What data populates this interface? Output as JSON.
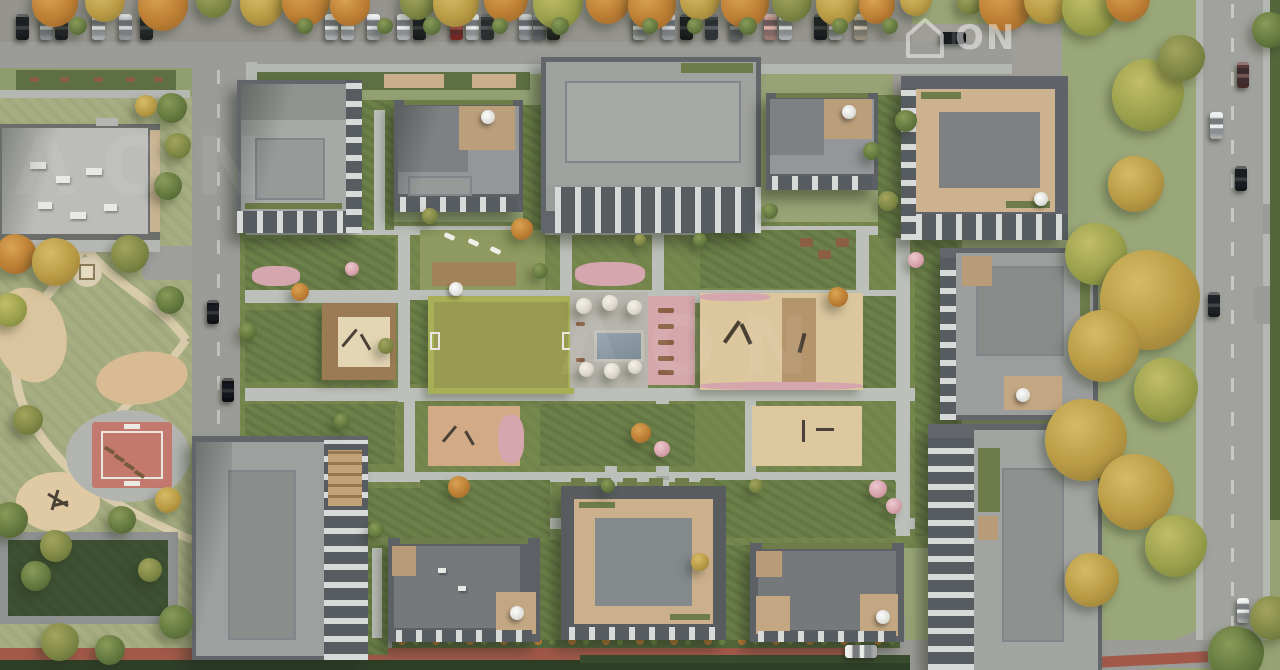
{
  "watermark": {
    "logo_text": "ON",
    "tile_text": "ΛΟΝ"
  },
  "colors": {
    "grass_base": "#93a173",
    "park_grass": "#a7ae82",
    "courtyard_green": "#77884f",
    "asphalt": "#9b9b97",
    "path_light": "#bdc0ba",
    "park_path": "#d8cbab",
    "sand": "#dcc69d",
    "roof_light": "#a7a9a7",
    "roof_inset": "#979a98",
    "roof_dark": "#7d8181",
    "building_edge": "#62666a",
    "facade_light": "#d8dada",
    "facade_dark": "#575c60",
    "terrace_wood": "#c9ae8c",
    "sport_court_red": "#c4796f",
    "pool_water": "#8795a0",
    "flower_pink": "#d5a6ad",
    "hedge_green": "#5e6f44",
    "dark_hedge": "#2e3f28",
    "autumn_orange": "#bc7e33",
    "autumn_yellow": "#b89a44",
    "tree_green": "#64793f",
    "deck_wood": "#9b7b53",
    "terracotta_path": "#a2594a",
    "car_red": "#a93732",
    "watermark_white": "#ffffff"
  },
  "scene": {
    "regions": [
      "top-street-parking",
      "school-building",
      "public-park",
      "sport-court",
      "residential-courtyard",
      "central-lawn",
      "plaza-with-pool",
      "playgrounds",
      "perimeter-apartment-buildings",
      "east-street",
      "south-lane"
    ],
    "cars": [
      {
        "x": 16,
        "y": 14,
        "w": 13,
        "h": 26,
        "c": "#1e2124"
      },
      {
        "x": 40,
        "y": 14,
        "w": 13,
        "h": 26,
        "c": "#c3c7ca"
      },
      {
        "x": 55,
        "y": 14,
        "w": 13,
        "h": 26,
        "c": "#26282b"
      },
      {
        "x": 92,
        "y": 14,
        "w": 13,
        "h": 26,
        "c": "#eceeee"
      },
      {
        "x": 119,
        "y": 14,
        "w": 13,
        "h": 26,
        "c": "#c9cdd0"
      },
      {
        "x": 140,
        "y": 14,
        "w": 13,
        "h": 26,
        "c": "#2b2d30"
      },
      {
        "x": 325,
        "y": 14,
        "w": 13,
        "h": 26,
        "c": "#eceeee"
      },
      {
        "x": 341,
        "y": 14,
        "w": 13,
        "h": 26,
        "c": "#f0f1f2"
      },
      {
        "x": 367,
        "y": 14,
        "w": 13,
        "h": 26,
        "c": "#e8eaec"
      },
      {
        "x": 397,
        "y": 14,
        "w": 13,
        "h": 26,
        "c": "#eef0f1"
      },
      {
        "x": 413,
        "y": 14,
        "w": 13,
        "h": 26,
        "c": "#1f2022"
      },
      {
        "x": 450,
        "y": 14,
        "w": 13,
        "h": 26,
        "c": "#a93732"
      },
      {
        "x": 466,
        "y": 14,
        "w": 13,
        "h": 26,
        "c": "#eef0f1"
      },
      {
        "x": 481,
        "y": 14,
        "w": 13,
        "h": 26,
        "c": "#3c4044"
      },
      {
        "x": 519,
        "y": 14,
        "w": 13,
        "h": 26,
        "c": "#c8ccd0"
      },
      {
        "x": 533,
        "y": 14,
        "w": 13,
        "h": 26,
        "c": "#83878b"
      },
      {
        "x": 547,
        "y": 14,
        "w": 13,
        "h": 26,
        "c": "#232527"
      },
      {
        "x": 633,
        "y": 14,
        "w": 13,
        "h": 26,
        "c": "#e9eaeb"
      },
      {
        "x": 662,
        "y": 14,
        "w": 13,
        "h": 26,
        "c": "#cdd1d4"
      },
      {
        "x": 680,
        "y": 14,
        "w": 13,
        "h": 26,
        "c": "#1b1d1f"
      },
      {
        "x": 705,
        "y": 14,
        "w": 13,
        "h": 26,
        "c": "#43474b"
      },
      {
        "x": 730,
        "y": 14,
        "w": 13,
        "h": 26,
        "c": "#8e9296"
      },
      {
        "x": 764,
        "y": 14,
        "w": 13,
        "h": 26,
        "c": "#d8a49c"
      },
      {
        "x": 779,
        "y": 14,
        "w": 13,
        "h": 26,
        "c": "#eff0f1"
      },
      {
        "x": 814,
        "y": 14,
        "w": 13,
        "h": 26,
        "c": "#212326"
      },
      {
        "x": 829,
        "y": 14,
        "w": 13,
        "h": 26,
        "c": "#edeeee"
      },
      {
        "x": 854,
        "y": 14,
        "w": 13,
        "h": 26,
        "c": "#cfc2ab"
      },
      {
        "x": 940,
        "y": 32,
        "w": 26,
        "h": 12,
        "c": "#17191b",
        "cls": "car-h"
      },
      {
        "x": 207,
        "y": 300,
        "w": 12,
        "h": 24,
        "c": "#141619"
      },
      {
        "x": 222,
        "y": 378,
        "w": 12,
        "h": 24,
        "c": "#0e1013"
      },
      {
        "x": 1237,
        "y": 62,
        "w": 12,
        "h": 26,
        "c": "#5d3a36"
      },
      {
        "x": 1210,
        "y": 112,
        "w": 13,
        "h": 27,
        "c": "#e9ebec"
      },
      {
        "x": 1235,
        "y": 166,
        "w": 12,
        "h": 25,
        "c": "#1b1d20"
      },
      {
        "x": 1208,
        "y": 292,
        "w": 12,
        "h": 25,
        "c": "#232528"
      },
      {
        "x": 1237,
        "y": 598,
        "w": 12,
        "h": 25,
        "c": "#eceded"
      },
      {
        "x": 845,
        "y": 645,
        "w": 32,
        "h": 13,
        "c": "#e8e9e7",
        "cls": "car-h"
      }
    ],
    "trees": [
      {
        "x": 55,
        "y": 4,
        "s": 46,
        "cls": "t-or"
      },
      {
        "x": 105,
        "y": 2,
        "s": 40,
        "cls": "t-ye"
      },
      {
        "x": 163,
        "y": 6,
        "s": 50,
        "cls": "t-or"
      },
      {
        "x": 214,
        "y": 0,
        "s": 36,
        "cls": "t-ol"
      },
      {
        "x": 262,
        "y": 4,
        "s": 44,
        "cls": "t-ye"
      },
      {
        "x": 306,
        "y": 2,
        "s": 48,
        "cls": "t-or"
      },
      {
        "x": 350,
        "y": 6,
        "s": 40,
        "cls": "t-or"
      },
      {
        "x": 418,
        "y": 2,
        "s": 36,
        "cls": "t-ol"
      },
      {
        "x": 456,
        "y": 4,
        "s": 46,
        "cls": "t-ye"
      },
      {
        "x": 506,
        "y": 0,
        "s": 44,
        "cls": "t-or"
      },
      {
        "x": 558,
        "y": 4,
        "s": 50,
        "cls": "t-yg"
      },
      {
        "x": 608,
        "y": 2,
        "s": 44,
        "cls": "t-or"
      },
      {
        "x": 652,
        "y": 6,
        "s": 48,
        "cls": "t-or"
      },
      {
        "x": 700,
        "y": 0,
        "s": 40,
        "cls": "t-ye"
      },
      {
        "x": 745,
        "y": 4,
        "s": 48,
        "cls": "t-or"
      },
      {
        "x": 792,
        "y": 2,
        "s": 40,
        "cls": "t-ol"
      },
      {
        "x": 838,
        "y": 4,
        "s": 44,
        "cls": "t-ye"
      },
      {
        "x": 877,
        "y": 6,
        "s": 36,
        "cls": "t-or"
      },
      {
        "x": 916,
        "y": 0,
        "s": 32,
        "cls": "t-ye"
      },
      {
        "x": 970,
        "y": 2,
        "s": 26,
        "cls": "t-ol"
      },
      {
        "x": 1006,
        "y": 4,
        "s": 54,
        "cls": "t-or"
      },
      {
        "x": 1048,
        "y": 0,
        "s": 48,
        "cls": "t-ye"
      },
      {
        "x": 1090,
        "y": 8,
        "s": 56,
        "cls": "t-yg"
      },
      {
        "x": 1128,
        "y": 0,
        "s": 44,
        "cls": "t-or"
      },
      {
        "x": 78,
        "y": 26,
        "s": 18,
        "cls": "t-gr"
      },
      {
        "x": 305,
        "y": 26,
        "s": 16,
        "cls": "t-gr"
      },
      {
        "x": 385,
        "y": 26,
        "s": 16,
        "cls": "t-gr"
      },
      {
        "x": 432,
        "y": 26,
        "s": 18,
        "cls": "t-gr"
      },
      {
        "x": 500,
        "y": 26,
        "s": 16,
        "cls": "t-gr"
      },
      {
        "x": 560,
        "y": 26,
        "s": 18,
        "cls": "t-gr"
      },
      {
        "x": 650,
        "y": 26,
        "s": 16,
        "cls": "t-gr"
      },
      {
        "x": 695,
        "y": 26,
        "s": 16,
        "cls": "t-gr"
      },
      {
        "x": 748,
        "y": 26,
        "s": 18,
        "cls": "t-gr"
      },
      {
        "x": 840,
        "y": 26,
        "s": 16,
        "cls": "t-gr"
      },
      {
        "x": 890,
        "y": 26,
        "s": 16,
        "cls": "t-gr"
      },
      {
        "x": 1148,
        "y": 95,
        "s": 72,
        "cls": "t-yg"
      },
      {
        "x": 1182,
        "y": 58,
        "s": 46,
        "cls": "t-ol"
      },
      {
        "x": 1136,
        "y": 184,
        "s": 56,
        "cls": "t-ye"
      },
      {
        "x": 1096,
        "y": 254,
        "s": 62,
        "cls": "t-yg"
      },
      {
        "x": 1150,
        "y": 300,
        "s": 100,
        "cls": "t-ye"
      },
      {
        "x": 1104,
        "y": 346,
        "s": 72,
        "cls": "t-ye"
      },
      {
        "x": 1166,
        "y": 390,
        "s": 64,
        "cls": "t-yg"
      },
      {
        "x": 1086,
        "y": 440,
        "s": 82,
        "cls": "t-ye"
      },
      {
        "x": 1136,
        "y": 492,
        "s": 76,
        "cls": "t-ye"
      },
      {
        "x": 1176,
        "y": 546,
        "s": 62,
        "cls": "t-yg"
      },
      {
        "x": 1092,
        "y": 580,
        "s": 54,
        "cls": "t-ye"
      },
      {
        "x": 1236,
        "y": 654,
        "s": 56,
        "cls": "t-gr"
      },
      {
        "x": 1272,
        "y": 618,
        "s": 44,
        "cls": "t-ol"
      },
      {
        "x": 1270,
        "y": 30,
        "s": 36,
        "cls": "t-gr"
      },
      {
        "x": 16,
        "y": 254,
        "s": 40,
        "cls": "t-or"
      },
      {
        "x": 56,
        "y": 262,
        "s": 48,
        "cls": "t-ye"
      },
      {
        "x": 130,
        "y": 254,
        "s": 38,
        "cls": "t-ol"
      },
      {
        "x": 10,
        "y": 310,
        "s": 34,
        "cls": "t-yg"
      },
      {
        "x": 170,
        "y": 300,
        "s": 28,
        "cls": "t-gr"
      },
      {
        "x": 28,
        "y": 420,
        "s": 30,
        "cls": "t-ol"
      },
      {
        "x": 10,
        "y": 520,
        "s": 36,
        "cls": "t-gr"
      },
      {
        "x": 56,
        "y": 546,
        "s": 32,
        "cls": "t-ol"
      },
      {
        "x": 122,
        "y": 520,
        "s": 28,
        "cls": "t-gr"
      },
      {
        "x": 168,
        "y": 500,
        "s": 26,
        "cls": "t-ye"
      },
      {
        "x": 36,
        "y": 576,
        "s": 30,
        "cls": "t-gr"
      },
      {
        "x": 150,
        "y": 570,
        "s": 24,
        "cls": "t-ol"
      },
      {
        "x": 176,
        "y": 622,
        "s": 34,
        "cls": "t-gr"
      },
      {
        "x": 60,
        "y": 642,
        "s": 38,
        "cls": "t-ol"
      },
      {
        "x": 110,
        "y": 650,
        "s": 30,
        "cls": "t-gr"
      },
      {
        "x": 172,
        "y": 108,
        "s": 30,
        "cls": "t-gr"
      },
      {
        "x": 178,
        "y": 146,
        "s": 26,
        "cls": "t-ol"
      },
      {
        "x": 168,
        "y": 186,
        "s": 28,
        "cls": "t-gr"
      },
      {
        "x": 146,
        "y": 106,
        "s": 22,
        "cls": "t-ye"
      },
      {
        "x": 522,
        "y": 229,
        "s": 22,
        "cls": "t-or"
      },
      {
        "x": 838,
        "y": 297,
        "s": 20,
        "cls": "t-or"
      },
      {
        "x": 641,
        "y": 433,
        "s": 20,
        "cls": "t-or"
      },
      {
        "x": 300,
        "y": 292,
        "s": 18,
        "cls": "t-or"
      },
      {
        "x": 459,
        "y": 487,
        "s": 22,
        "cls": "t-or"
      },
      {
        "x": 700,
        "y": 562,
        "s": 18,
        "cls": "t-ye"
      },
      {
        "x": 342,
        "y": 421,
        "s": 16,
        "cls": "t-gr"
      },
      {
        "x": 248,
        "y": 331,
        "s": 18,
        "cls": "t-gr"
      },
      {
        "x": 386,
        "y": 346,
        "s": 16,
        "cls": "t-ol"
      },
      {
        "x": 540,
        "y": 271,
        "s": 16,
        "cls": "t-gr"
      },
      {
        "x": 906,
        "y": 121,
        "s": 22,
        "cls": "t-gr"
      },
      {
        "x": 888,
        "y": 201,
        "s": 20,
        "cls": "t-ol"
      },
      {
        "x": 872,
        "y": 151,
        "s": 18,
        "cls": "t-gr"
      },
      {
        "x": 770,
        "y": 211,
        "s": 16,
        "cls": "t-gr"
      },
      {
        "x": 430,
        "y": 216,
        "s": 16,
        "cls": "t-ol"
      },
      {
        "x": 878,
        "y": 489,
        "s": 18,
        "cls": "t-pk"
      },
      {
        "x": 894,
        "y": 506,
        "s": 16,
        "cls": "t-pk"
      },
      {
        "x": 662,
        "y": 449,
        "s": 16,
        "cls": "t-pk"
      },
      {
        "x": 916,
        "y": 260,
        "s": 16,
        "cls": "t-pk"
      },
      {
        "x": 352,
        "y": 269,
        "s": 14,
        "cls": "t-pk"
      },
      {
        "x": 608,
        "y": 486,
        "s": 14,
        "cls": "t-gr"
      },
      {
        "x": 756,
        "y": 486,
        "s": 14,
        "cls": "t-ol"
      },
      {
        "x": 700,
        "y": 240,
        "s": 14,
        "cls": "t-gr"
      },
      {
        "x": 640,
        "y": 240,
        "s": 12,
        "cls": "t-ol"
      },
      {
        "x": 376,
        "y": 530,
        "s": 16,
        "cls": "t-gr"
      },
      {
        "x": 584,
        "y": 306,
        "s": 16,
        "cls": "t-wh"
      },
      {
        "x": 610,
        "y": 303,
        "s": 16,
        "cls": "t-wh"
      },
      {
        "x": 634,
        "y": 307,
        "s": 15,
        "cls": "t-wh"
      },
      {
        "x": 586,
        "y": 369,
        "s": 15,
        "cls": "t-wh"
      },
      {
        "x": 612,
        "y": 371,
        "s": 16,
        "cls": "t-wh"
      },
      {
        "x": 635,
        "y": 367,
        "s": 14,
        "cls": "t-wh"
      }
    ]
  }
}
